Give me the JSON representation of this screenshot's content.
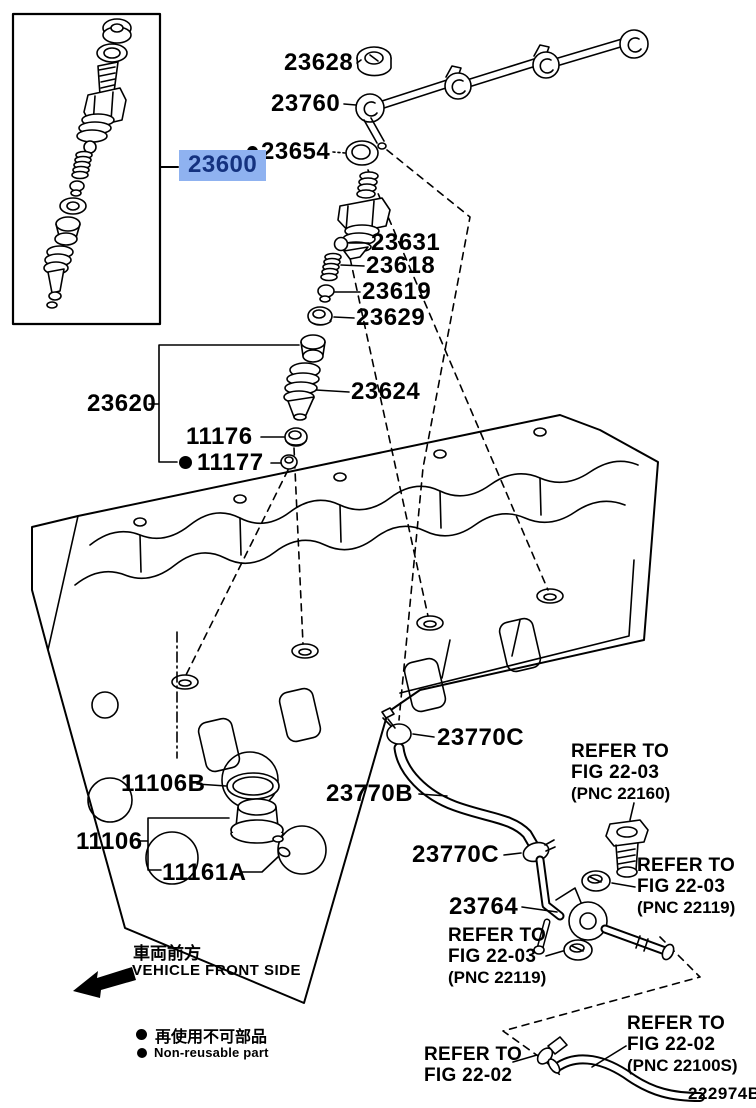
{
  "colors": {
    "highlight_bg": "#8FB2F0",
    "highlight_text": "#14327F",
    "line": "#000000"
  },
  "labels": {
    "n23628": "23628",
    "n23760": "23760",
    "n23654": "23654",
    "n23600": "23600",
    "n23631": "23631",
    "n23618": "23618",
    "n23619": "23619",
    "n23629": "23629",
    "n23620": "23620",
    "n23624": "23624",
    "n11176": "11176",
    "n11177": "11177",
    "n11106B": "11106B",
    "n11106": "11106",
    "n11161A": "11161A",
    "n23770C_a": "23770C",
    "n23770B": "23770B",
    "n23770C_b": "23770C",
    "n23764": "23764"
  },
  "refer_notes": {
    "r22160": [
      "REFER TO",
      "FIG 22-03",
      "(PNC 22160)"
    ],
    "r22119a": [
      "REFER TO",
      "FIG 22-03",
      "(PNC 22119)"
    ],
    "r22119b": [
      "REFER TO",
      "FIG 22-03",
      "(PNC 22119)"
    ],
    "r2202a": [
      "REFER TO",
      "FIG 22-02"
    ],
    "r2202b": [
      "REFER TO",
      "FIG 22-02",
      "(PNC 22100S)"
    ]
  },
  "front_marker": {
    "jp": "車両前方",
    "en": "VEHICLE FRONT SIDE"
  },
  "legend": {
    "jp": "再使用不可部品",
    "en": "Non-reusable part"
  },
  "diagram_code": "222974B"
}
